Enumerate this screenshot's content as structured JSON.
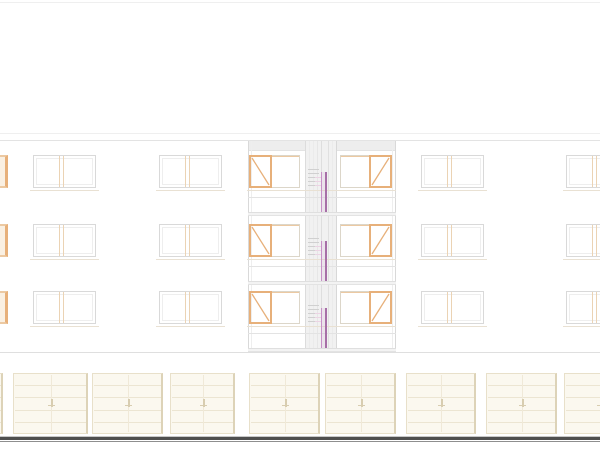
{
  "drawing": {
    "description": "architectural front elevation, 3-storey apartment building with central stair bay and garage door row",
    "canvas": {
      "w": 600,
      "h": 450,
      "bg": "#ffffff",
      "top_border_y": 2
    },
    "palette": {
      "outline_light": "#efefef",
      "outline": "#e3e3e3",
      "outline_dark": "#dfdfdf",
      "frame_gray": "#d9d9d9",
      "frame_inner": "#eeeeee",
      "tan": "#ebd3b4",
      "tan_line": "#e9e1d3",
      "orange": "#e7b07a",
      "orange_soft": "#ecc9a2",
      "orange_wash": "#faf0e2",
      "pane_gray": "#dcd6c9",
      "bay_band": "#ededed",
      "stair_bg": "#f1f1f1",
      "stair_tick": "#d0d0d0",
      "stair_tick_pink": "#ecd4e4",
      "purple": "#a76fa7",
      "purple_light": "#c791c7",
      "purple_wash": "rgba(199,145,199,0.14)",
      "door_fill": "#fbf8ef",
      "door_border": "#e8e0ca",
      "door_border_dark": "#ddd3b8",
      "door_slat": "#ece5d2",
      "door_center": "#f0e9d8",
      "door_handle": "#d8cdb0",
      "ground_light": "#c8c8c8",
      "ground_dark": "#4f4f4f",
      "ground_mid": "#8f8f8f"
    },
    "facade": {
      "x": 0,
      "w": 600,
      "parapet_y1": 133,
      "parapet_y2": 140,
      "bottom_y": 352,
      "win_h": 33,
      "floors": [
        {
          "win_y": 155
        },
        {
          "win_y": 224
        },
        {
          "win_y": 291
        }
      ],
      "mullion_offset": 26,
      "mullion_gap": 4,
      "windows_plain": [
        {
          "x": 33,
          "w": 63
        },
        {
          "x": 159,
          "w": 63
        },
        {
          "x": 421,
          "w": 63
        },
        {
          "x": 566,
          "w": 46
        }
      ],
      "window_left_partial": {
        "x": -26,
        "w": 34
      },
      "windows_bay": [
        {
          "x": 249,
          "w": 51,
          "casement": "left",
          "casement_w": 23
        },
        {
          "x": 340,
          "w": 52,
          "casement": "right",
          "casement_w": 23
        }
      ],
      "bay": {
        "x": 248,
        "w": 148,
        "top_band": {
          "y": 141,
          "h": 10
        },
        "rail_offsets": {
          "sill": 35,
          "rail": 42,
          "slab_top": 57,
          "slab_h": 4
        }
      },
      "stair": {
        "x": 305,
        "w": 32,
        "y": 141,
        "bottom": 352,
        "vlines": [
          [
            0,
            "#dcdcdc"
          ],
          [
            4,
            "#ebebeb"
          ],
          [
            8,
            "#ebebeb"
          ],
          [
            12,
            "#e6e6e6"
          ],
          [
            16,
            "#dedede"
          ],
          [
            23,
            "#e0e0e0"
          ],
          [
            27,
            "#ebebeb"
          ],
          [
            31,
            "#d8d8d8"
          ]
        ],
        "tick_x": 308,
        "tick_w": 11,
        "tick_dy": [
          14,
          18,
          22,
          26,
          30
        ],
        "pink_x": 315,
        "pink_w": 7,
        "pink_dy": [
          22,
          26,
          30
        ],
        "door": {
          "x": 321,
          "w": 6,
          "dy_top": 17,
          "h": 40
        }
      }
    },
    "garage": {
      "y": 373,
      "h": 61,
      "slats": 4,
      "doors_x": [
        -68,
        13,
        92,
        170,
        249,
        325,
        406,
        486,
        564
      ],
      "doors_w": [
        71,
        75,
        71,
        65,
        71,
        71,
        70,
        71,
        71
      ]
    },
    "ground": {
      "light_y": 436,
      "dark_y": 437,
      "dark_h": 3,
      "mid_y": 441
    }
  }
}
